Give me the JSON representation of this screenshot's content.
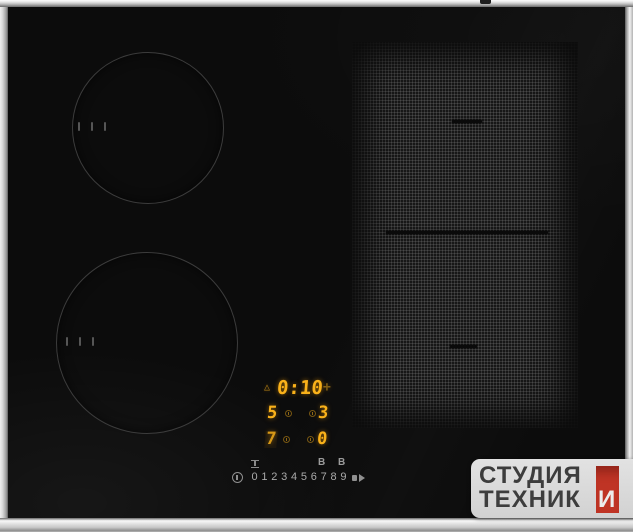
{
  "display": {
    "timer": {
      "value": "0:10",
      "plus_label": "+"
    },
    "levels": {
      "top_left": "5",
      "top_right": "3",
      "bottom_left": "7",
      "bottom_right": "0"
    }
  },
  "touch_panel": {
    "digits": [
      "0",
      "1",
      "2",
      "3",
      "4",
      "5",
      "6",
      "7",
      "8",
      "9"
    ],
    "boosters": [
      "B",
      "B"
    ]
  },
  "watermark": {
    "line1": "СТУДИЯ",
    "line2": "ТЕХНИК",
    "accent_letter": "И"
  },
  "icons": {
    "alarm_timer": "△",
    "zone_timer_indicator": "small-clock-circle",
    "power": "standby-circle-bar",
    "pause": "i-beam",
    "key_lock": "bar-with-arrow"
  },
  "colors": {
    "led_amber": "#f9b11a",
    "glass_black": "#0c0c0c",
    "steel_silver": "#c9c9c9",
    "watermark_bg": "#d7d7d7",
    "watermark_red": "#bf3425",
    "watermark_text": "#3d3d3d"
  }
}
